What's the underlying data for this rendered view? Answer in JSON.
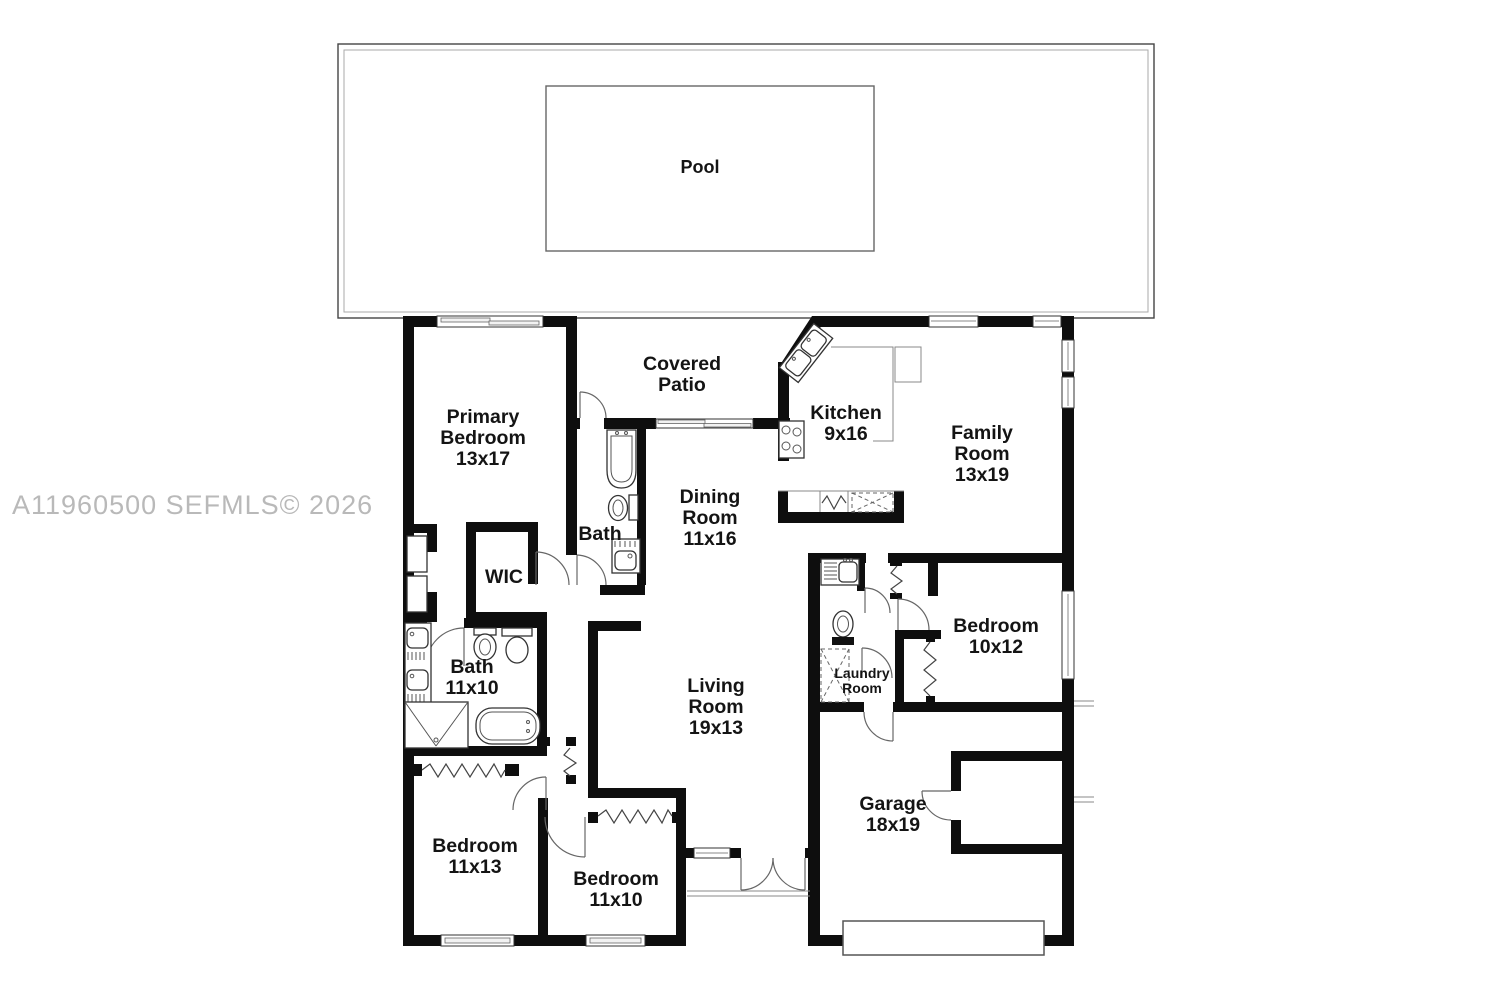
{
  "watermark": "A11960500  SEFMLS© 2026",
  "pool": {
    "label": "Pool"
  },
  "rooms": {
    "covered_patio": {
      "line1": "Covered",
      "line2": "Patio"
    },
    "primary_bedroom": {
      "line1": "Primary",
      "line2": "Bedroom",
      "line3": "13x17"
    },
    "hall_bath": {
      "line1": "Bath"
    },
    "wic": {
      "line1": "WIC"
    },
    "primary_bath": {
      "line1": "Bath",
      "line2": "11x10"
    },
    "dining_room": {
      "line1": "Dining",
      "line2": "Room",
      "line3": "11x16"
    },
    "kitchen": {
      "line1": "Kitchen",
      "line2": "9x16"
    },
    "family_room": {
      "line1": "Family",
      "line2": "Room",
      "line3": "13x19"
    },
    "bedroom_right": {
      "line1": "Bedroom",
      "line2": "10x12"
    },
    "laundry_room": {
      "line1": "Laundry",
      "line2": "Room"
    },
    "living_room": {
      "line1": "Living",
      "line2": "Room",
      "line3": "19x13"
    },
    "bedroom_left": {
      "line1": "Bedroom",
      "line2": "11x13"
    },
    "bedroom_center": {
      "line1": "Bedroom",
      "line2": "11x10"
    },
    "garage": {
      "line1": "Garage",
      "line2": "18x19"
    }
  },
  "colors": {
    "wall": "#0e0e0e",
    "thin_line": "#555555",
    "watermark": "#b9b9b9"
  }
}
